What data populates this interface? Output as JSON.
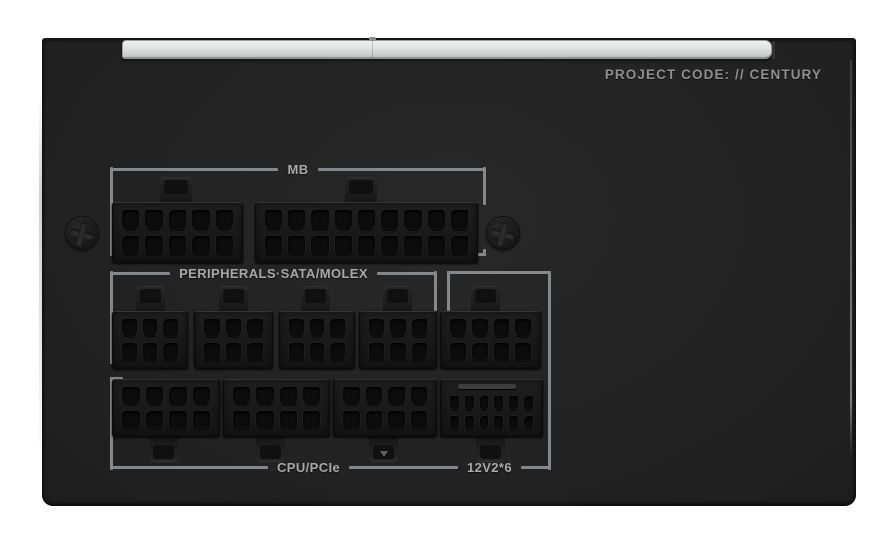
{
  "header": {
    "project_code": "PROJECT CODE: // CENTURY"
  },
  "groups": {
    "mb": {
      "label": "MB"
    },
    "peripherals": {
      "label": "PERIPHERALS·SATA/MOLEX"
    },
    "cpu_pcie": {
      "label": "CPU/PCIe"
    },
    "v12": {
      "label": "12V2*6"
    }
  },
  "colors": {
    "background": "#ffffff",
    "panel": "#232323",
    "bracket_line": "#84888c",
    "label_text": "#a6a8aa",
    "project_code_text": "#8e8f90",
    "top_strip": "#dfe1e1",
    "connector_body": "#171717",
    "pin_hole": "#0c0c0c"
  },
  "hardware": {
    "screws": [
      {
        "x": 82,
        "y": 233
      },
      {
        "x": 503,
        "y": 233
      }
    ],
    "connectors": [
      {
        "id": "mb-10pin",
        "group": "MB",
        "cols": 5,
        "rows": 2,
        "x": 112,
        "y": 202,
        "w": 131,
        "h": 61,
        "clip": "top",
        "clip_dx": 48,
        "clip_w": 32
      },
      {
        "id": "mb-18pin",
        "group": "MB",
        "cols": 9,
        "rows": 2,
        "x": 255,
        "y": 202,
        "w": 223,
        "h": 61,
        "clip": "top",
        "clip_dx": 90,
        "clip_w": 32
      },
      {
        "id": "peripheral-1",
        "group": "PERIPHERALS·SATA/MOLEX",
        "cols": 3,
        "rows": 2,
        "x": 112,
        "y": 311,
        "w": 76,
        "h": 58,
        "clip": "top",
        "clip_dx": 24
      },
      {
        "id": "peripheral-2",
        "group": "PERIPHERALS·SATA/MOLEX",
        "cols": 3,
        "rows": 2,
        "x": 194,
        "y": 311,
        "w": 79,
        "h": 58,
        "clip": "top",
        "clip_dx": 25
      },
      {
        "id": "peripheral-3",
        "group": "PERIPHERALS·SATA/MOLEX",
        "cols": 3,
        "rows": 2,
        "x": 279,
        "y": 311,
        "w": 76,
        "h": 58,
        "clip": "top",
        "clip_dx": 22
      },
      {
        "id": "peripheral-4",
        "group": "PERIPHERALS·SATA/MOLEX",
        "cols": 3,
        "rows": 2,
        "x": 359,
        "y": 311,
        "w": 78,
        "h": 58,
        "clip": "top",
        "clip_dx": 24
      },
      {
        "id": "aux-8pin",
        "group": "12V2*6",
        "cols": 4,
        "rows": 2,
        "x": 440,
        "y": 311,
        "w": 101,
        "h": 58,
        "clip": "top",
        "clip_dx": 31
      },
      {
        "id": "cpu-pcie-1",
        "group": "CPU/PCIe",
        "cols": 4,
        "rows": 2,
        "x": 112,
        "y": 379,
        "w": 108,
        "h": 58,
        "clip": "bottom",
        "clip_dx": 37
      },
      {
        "id": "cpu-pcie-2",
        "group": "CPU/PCIe",
        "cols": 4,
        "rows": 2,
        "x": 223,
        "y": 379,
        "w": 107,
        "h": 58,
        "clip": "bottom",
        "clip_dx": 33
      },
      {
        "id": "cpu-pcie-3",
        "group": "CPU/PCIe",
        "cols": 4,
        "rows": 2,
        "x": 333,
        "y": 379,
        "w": 104,
        "h": 58,
        "clip": "bottom",
        "clip_dx": 36,
        "mark": true
      },
      {
        "id": "12v2x6",
        "group": "12V2*6",
        "cols": 6,
        "rows": 2,
        "x": 440,
        "y": 379,
        "w": 103,
        "h": 58,
        "clip": "bottom",
        "clip_dx": 36,
        "sense": true
      }
    ]
  }
}
